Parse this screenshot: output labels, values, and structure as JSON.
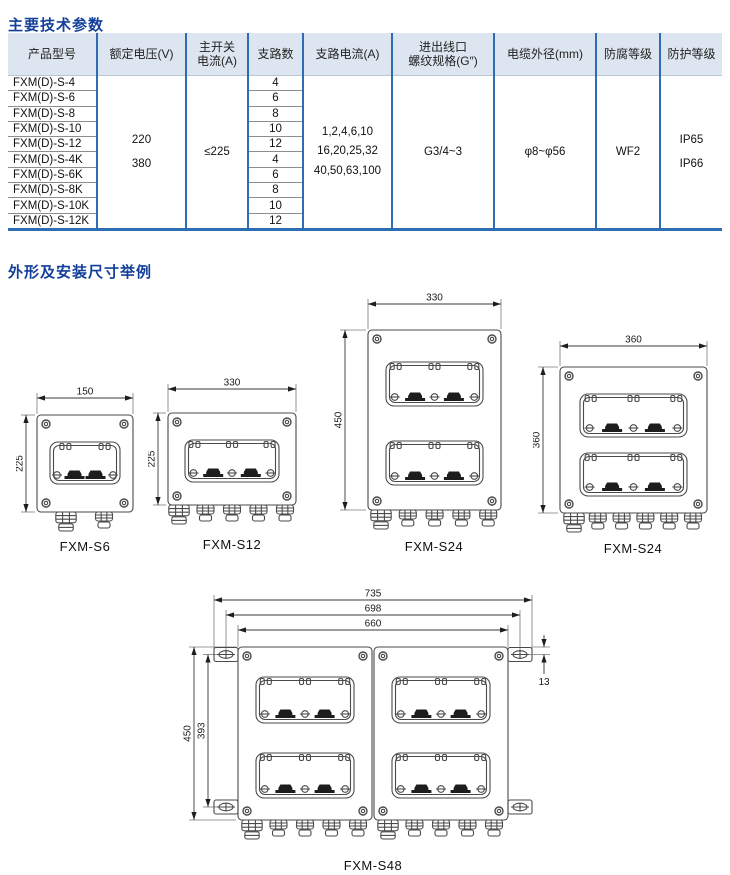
{
  "page": {
    "section1_title": "主要技术参数",
    "section2_title": "外形及安装尺寸举例"
  },
  "table": {
    "headers": [
      "产品型号",
      "额定电压(V)",
      "主开关\n电流(A)",
      "支路数",
      "支路电流(A)",
      "进出线口\n螺纹规格(G″)",
      "电缆外径(mm)",
      "防腐等级",
      "防护等级"
    ],
    "models": [
      "FXM(D)-S-4",
      "FXM(D)-S-6",
      "FXM(D)-S-8",
      "FXM(D)-S-10",
      "FXM(D)-S-12",
      "FXM(D)-S-4K",
      "FXM(D)-S-6K",
      "FXM(D)-S-8K",
      "FXM(D)-S-10K",
      "FXM(D)-S-12K"
    ],
    "branch_counts": [
      "4",
      "6",
      "8",
      "10",
      "12",
      "4",
      "6",
      "8",
      "10",
      "12"
    ],
    "merged": {
      "rated_voltage": "220\n380",
      "main_switch_current": "≤225",
      "branch_current": "1,2,4,6,10\n16,20,25,32\n40,50,63,100",
      "thread_spec": "G3/4~3",
      "cable_od": "φ8~φ56",
      "anticorrosion": "WF2",
      "protection": "IP65\nIP66"
    }
  },
  "drawings": [
    {
      "label": "FXM-S6",
      "dim_top": "150",
      "dim_left": "225"
    },
    {
      "label": "FXM-S12",
      "dim_top": "330",
      "dim_left": "225"
    },
    {
      "label": "FXM-S24",
      "dim_top": "330",
      "dim_left": "450"
    },
    {
      "label": "FXM-S24",
      "dim_top": "360",
      "dim_left": "360"
    },
    {
      "label": "FXM-S48",
      "dims_top": [
        "735",
        "698",
        "660"
      ],
      "dims_left": [
        "450",
        "393"
      ],
      "dim_right": "13"
    }
  ],
  "colors": {
    "accent_blue": "#2e6db4",
    "title_blue": "#14409a",
    "header_bg": "#dde6f0",
    "line_gray": "#4a4a4a"
  }
}
